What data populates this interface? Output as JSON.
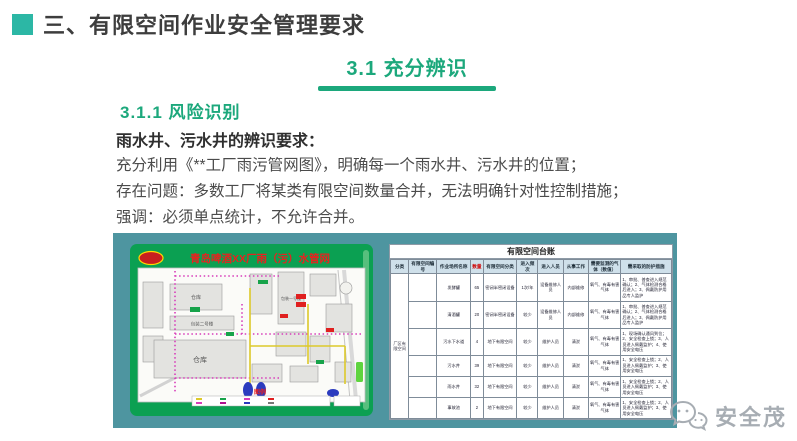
{
  "slide": {
    "header": {
      "title": "三、有限空间作业安全管理要求"
    },
    "section": {
      "title": "3.1  充分辨识"
    },
    "subsection": {
      "title": "3.1.1  风险识别"
    },
    "body": {
      "lead": "雨水井、污水井的辨识要求：",
      "lines": [
        "充分利用《**工厂雨污管网图》，明确每一个雨水井、污水井的位置；",
        "存在问题：多数工厂将某类有限空间数量合并，无法明确针对性控制措施；",
        "强调：必须单点统计，不允许合并。"
      ]
    },
    "footer": {
      "brand": "安全茂"
    }
  },
  "map": {
    "title": "青岛啤酒XX厂雨（污）水管网",
    "legend_label": "图例",
    "building_labels": [
      "仓库",
      "包装二号楼",
      "仓库",
      "包装一号楼"
    ]
  },
  "ledger": {
    "title": "有限空间台账",
    "columns": [
      "分类",
      "有限空间编号",
      "作业场所名称",
      "数量",
      "有限空间分类",
      "进入频次",
      "进入人员",
      "从事工作",
      "需要监测的气体（数值）",
      "需采取的防护措施"
    ],
    "category_label": "厂区有限空间",
    "rows": [
      {
        "code": "",
        "name": "发酵罐",
        "qty": "65",
        "type": "密闭半密闭设备",
        "freq": "1次/年",
        "people": "设备维修人员",
        "work": "内部维修",
        "gas": "氧气、有毒有害气体",
        "protect": "1、审批、普查进入规范确认；2、气体检测合格后进入；3、佩戴防护用品专人监护"
      },
      {
        "code": "",
        "name": "清酒罐",
        "qty": "20",
        "type": "密闭半密闭设备",
        "freq": "较少",
        "people": "设备维修人员",
        "work": "内部维修",
        "gas": "氧气、有毒有害气体",
        "protect": "1、审批、普查进入规范确认；2、气体检测合格后进入；3、佩戴防护用品专人监护"
      },
      {
        "code": "",
        "name": "污水下水道",
        "qty": "4",
        "type": "地下有限空间",
        "freq": "较少",
        "people": "维护人员",
        "work": "清淤",
        "gas": "氧气、有毒有害气体",
        "protect": "1、现场确认通风到位；2、安全检查上锁；3、人员进入佩戴监护；4、使用安全电压"
      },
      {
        "code": "",
        "name": "污水井",
        "qty": "39",
        "type": "地下有限空间",
        "freq": "较少",
        "people": "维护人员",
        "work": "清淤",
        "gas": "氧气、有毒有害气体",
        "protect": "1、安全检查上锁；2、人员进入佩戴监护；3、使用安全电压"
      },
      {
        "code": "",
        "name": "雨水井",
        "qty": "32",
        "type": "地下有限空间",
        "freq": "较少",
        "people": "维护人员",
        "work": "清淤",
        "gas": "氧气、有毒有害气体",
        "protect": "1、安全检查上锁；2、人员进入佩戴监护；3、使用安全电压"
      },
      {
        "code": "",
        "name": "事故池",
        "qty": "2",
        "type": "地下有限空间",
        "freq": "较少",
        "people": "维护人员",
        "work": "清淤",
        "gas": "氧气、有毒有害气体",
        "protect": "1、安全检查上锁；2、人员进入佩戴监护；3、使用安全电压"
      }
    ]
  },
  "colors": {
    "accent_green": "#1ca87c",
    "title_square_teal": "#2cb7a5",
    "panel_teal": "#4e95a0",
    "map_green": "#0ba052",
    "map_title_red": "#e8221f",
    "qty_red": "#cf0000",
    "table_header_bg": "#cfe0ea"
  }
}
